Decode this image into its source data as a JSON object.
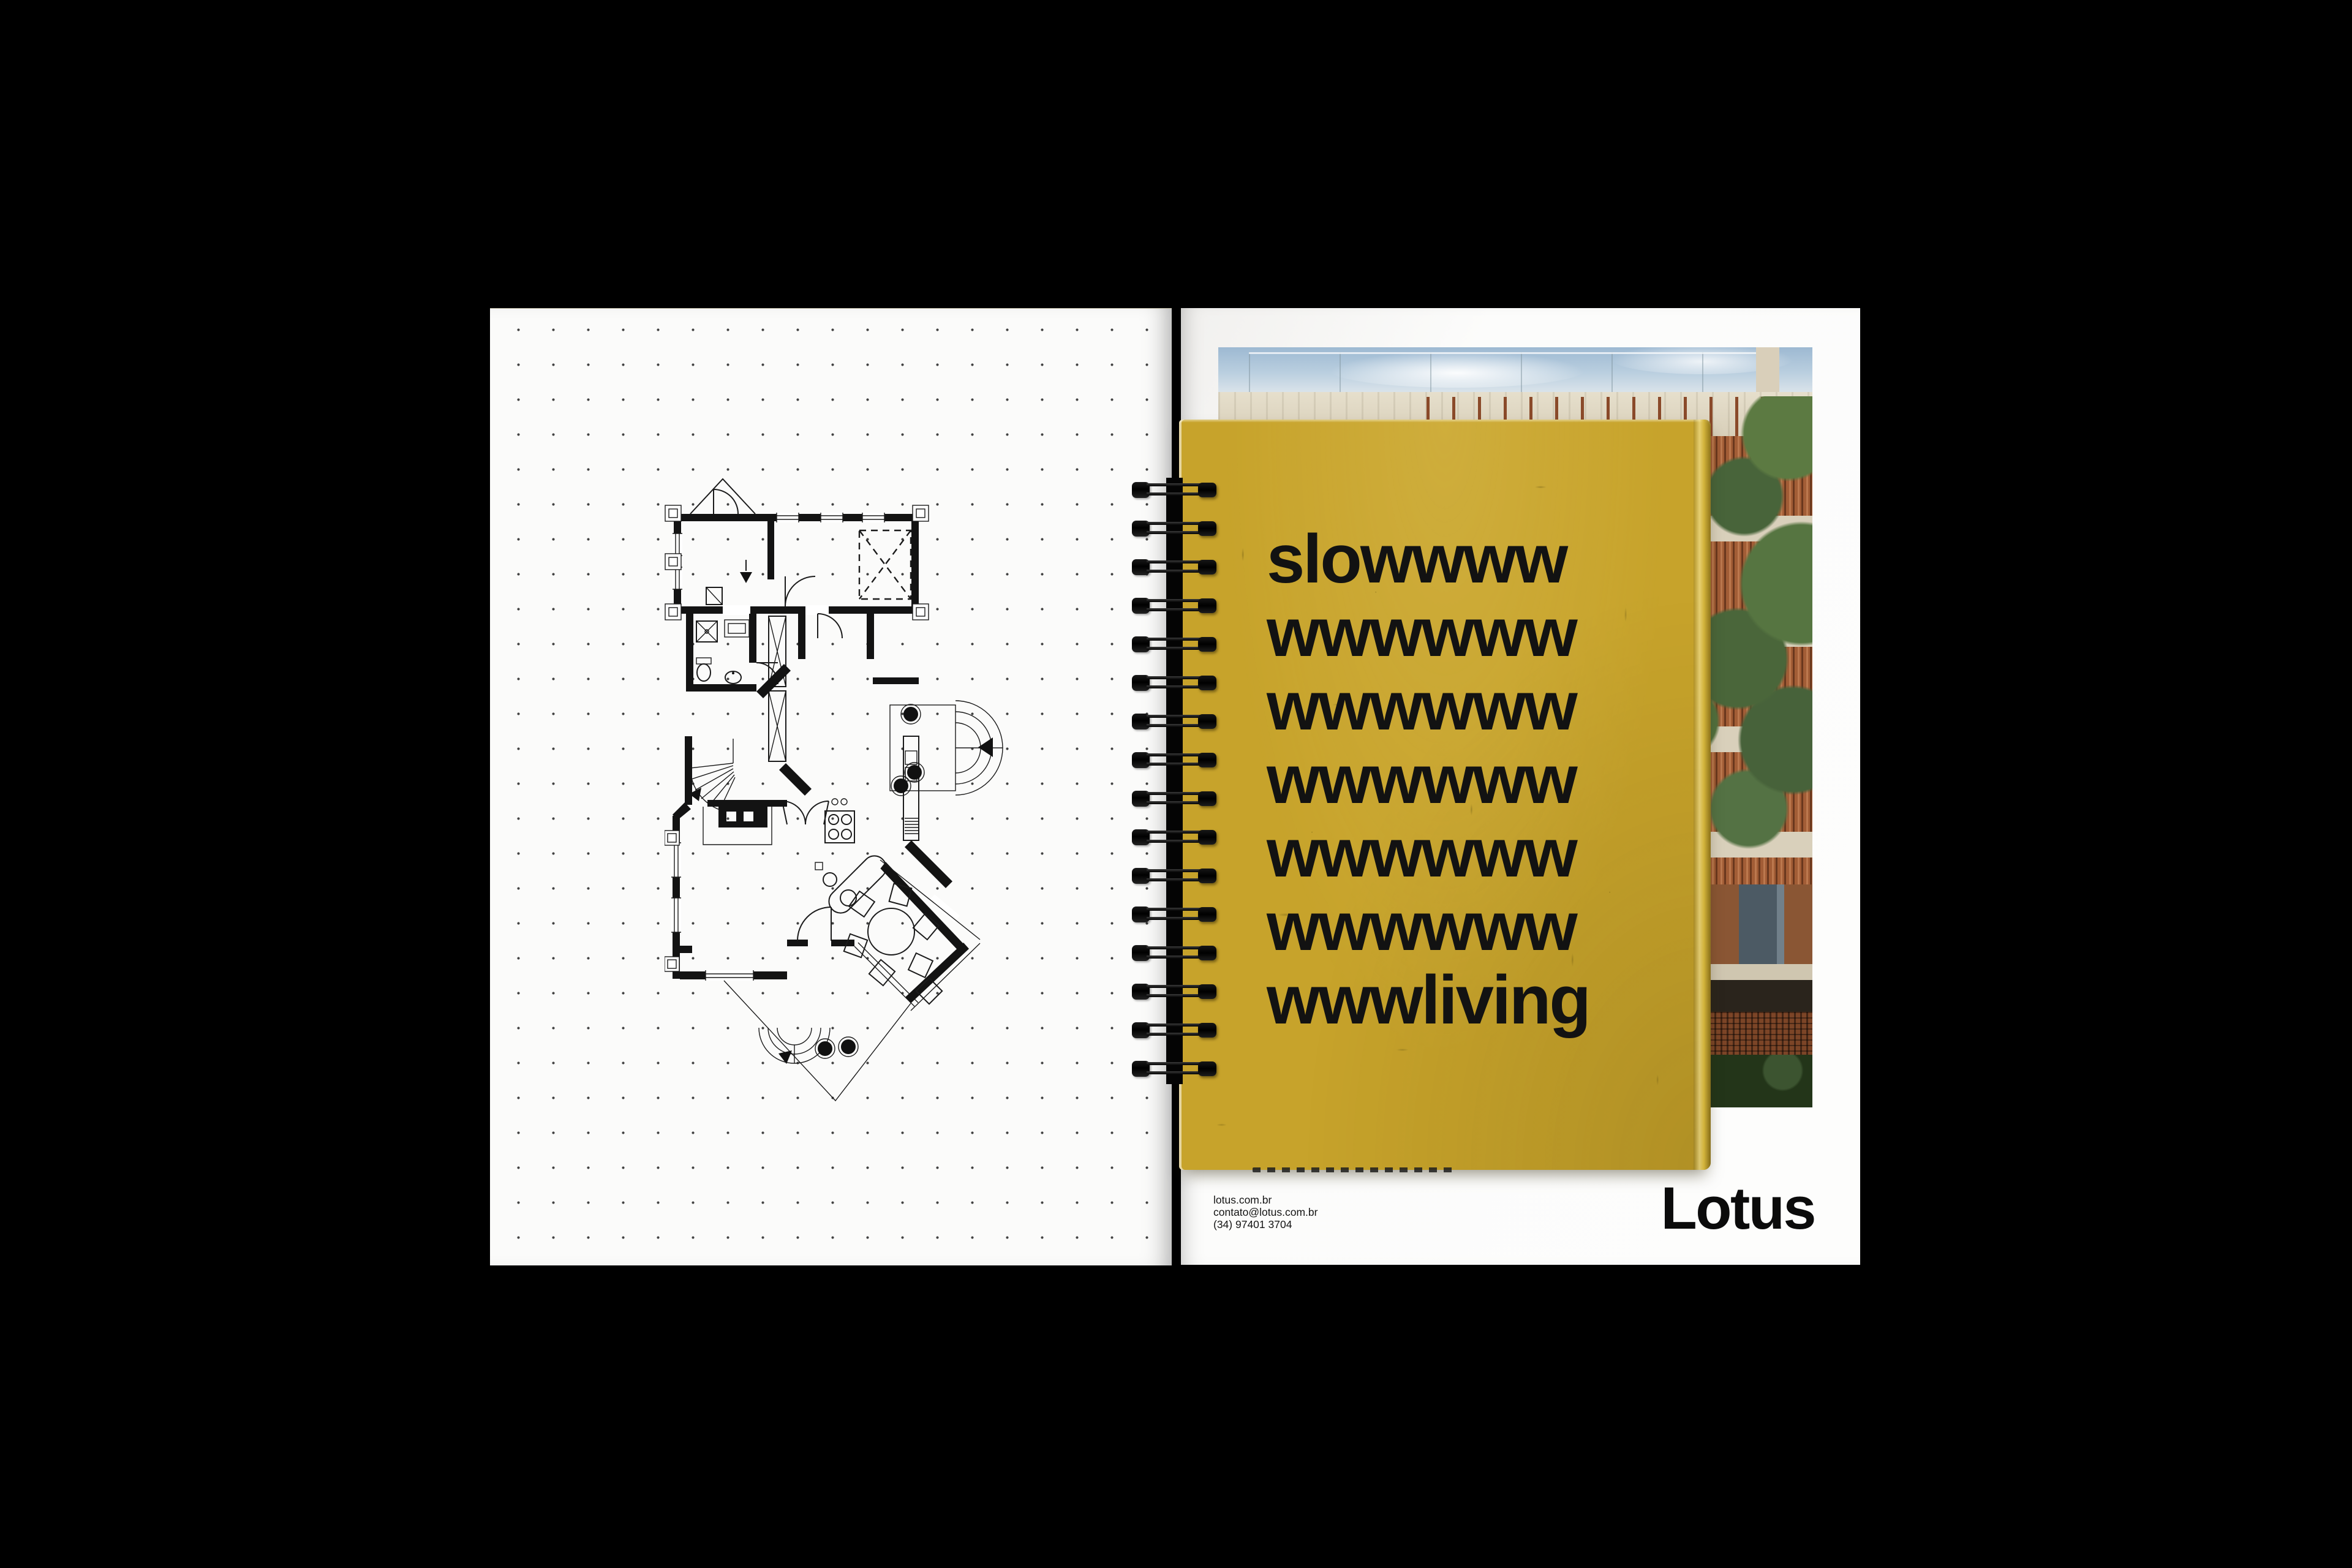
{
  "cover": {
    "lines": [
      "slowwww",
      "wwwwww",
      "wwwwww",
      "wwwwww",
      "wwwwww",
      "wwwwww",
      "wwwliving"
    ],
    "paper_color": "#c7a32b",
    "ink_color": "#121212"
  },
  "brand": {
    "wordmark": "Lotus"
  },
  "contact": {
    "website": "lotus.com.br",
    "email": "contato@lotus.com.br",
    "phone": "(34) 97401 3704"
  },
  "left_page": {
    "floor_plan_alt": "black-and-white architectural first-floor plan on dot-grid paper"
  },
  "photo": {
    "alt": "modern building with wood-slat facade, concrete slabs, glass roof railing and tree",
    "sky_color": "#a9c3d6",
    "concrete_color": "#ddd5c2",
    "wood_color": "#a25d36",
    "foliage_color": "#52703e"
  },
  "binding": {
    "loop_count": 16,
    "wire_color": "#0d0d0d"
  }
}
